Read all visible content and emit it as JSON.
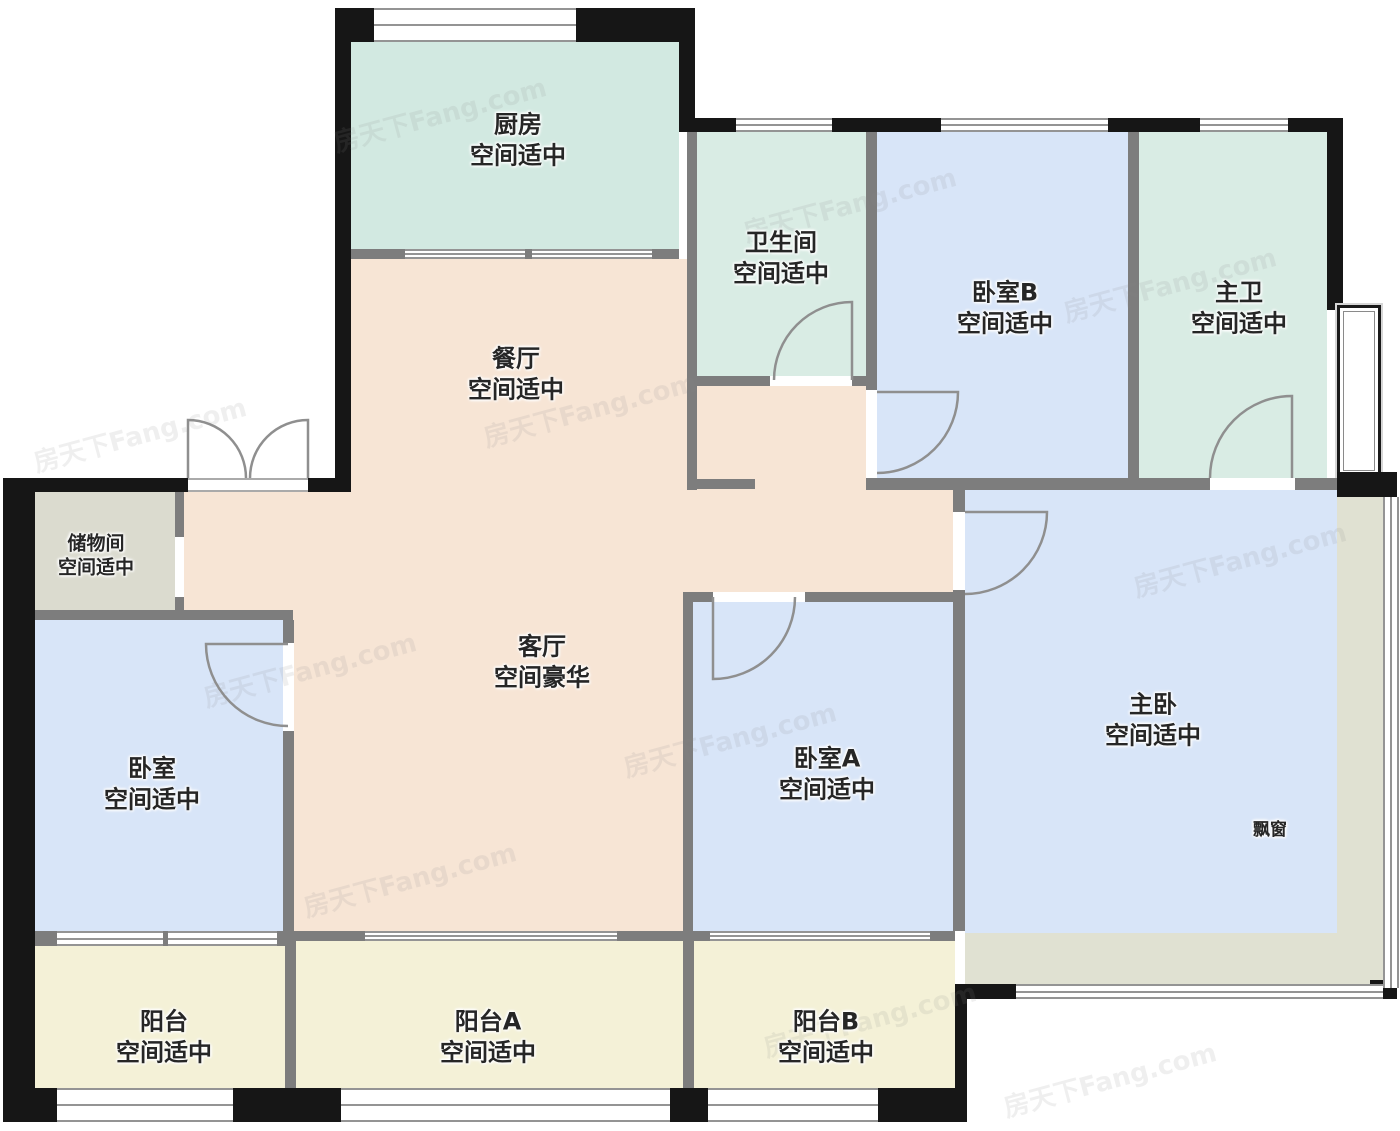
{
  "watermark": {
    "text": "房天下Fang.com"
  },
  "rooms": {
    "kitchen": {
      "name": "厨房",
      "note": "空间适中"
    },
    "bathroom": {
      "name": "卫生间",
      "note": "空间适中"
    },
    "bedroom_b": {
      "name": "卧室B",
      "note": "空间适中"
    },
    "master_bath": {
      "name": "主卫",
      "note": "空间适中"
    },
    "dining": {
      "name": "餐厅",
      "note": "空间适中"
    },
    "storage": {
      "name": "储物间",
      "note": "空间适中"
    },
    "living": {
      "name": "客厅",
      "note": "空间豪华"
    },
    "bedroom": {
      "name": "卧室",
      "note": "空间适中"
    },
    "bedroom_a": {
      "name": "卧室A",
      "note": "空间适中"
    },
    "master": {
      "name": "主卧",
      "note": "空间适中"
    },
    "bay_window": {
      "name": "飘窗"
    },
    "balcony": {
      "name": "阳台",
      "note": "空间适中"
    },
    "balcony_a": {
      "name": "阳台A",
      "note": "空间适中"
    },
    "balcony_b": {
      "name": "阳台B",
      "note": "空间适中"
    }
  },
  "colors": {
    "kitchen_mint": "#d2e9e1",
    "bath_mint": "#d9ece4",
    "bedroom_blue": "#d8e5f8",
    "living_peach": "#f7e5d5",
    "storage_grey": "#dbdbcf",
    "balcony_yellow": "#f4f1d7",
    "bay_beige": "#e0e1d2",
    "wall_black": "#161616",
    "wall_grey": "#7d7d7d"
  }
}
